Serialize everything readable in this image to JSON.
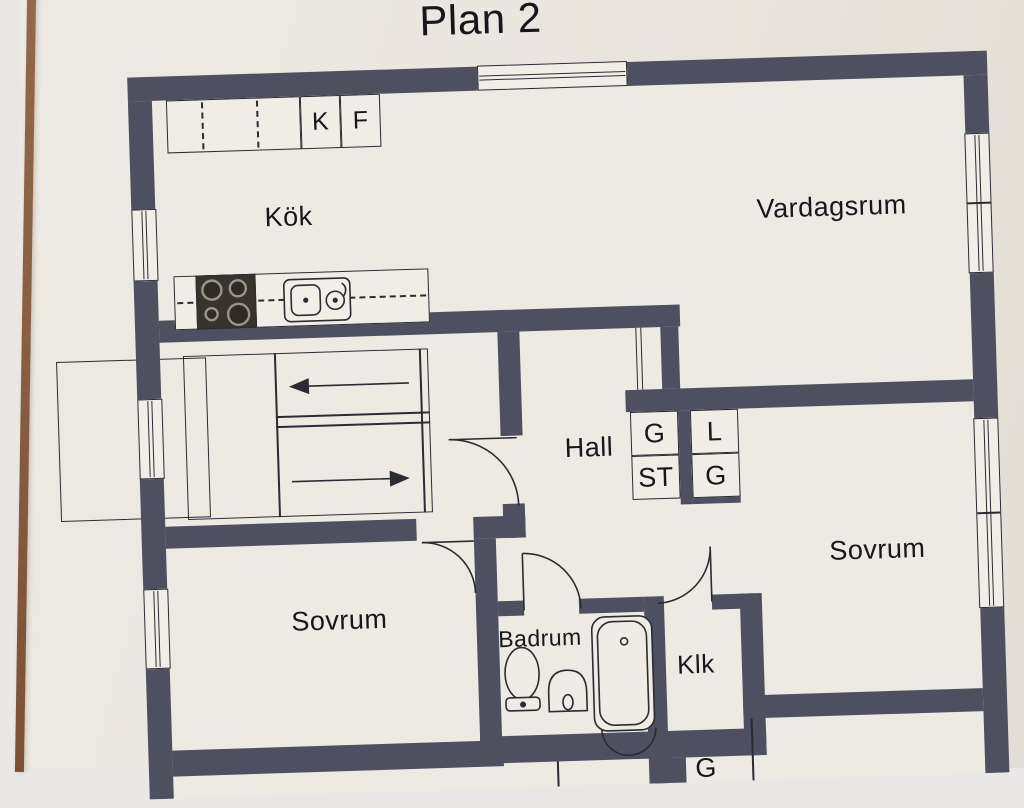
{
  "page": {
    "title": "Plan 2"
  },
  "floor_plan": {
    "rooms": {
      "kok": "Kök",
      "vardagsrum": "Vardagsrum",
      "hall": "Hall",
      "sovrum_left": "Sovrum",
      "sovrum_right": "Sovrum",
      "badrum": "Badrum",
      "klk": "Klk"
    },
    "kitchen_units": {
      "kyl": "K",
      "frys": "F"
    },
    "closets": {
      "garderob_1": "G",
      "stadskap": "ST",
      "linneskap": "L",
      "garderob_2": "G",
      "garderob_partial": "G"
    },
    "colors": {
      "wall": "#4e4f5f",
      "paper": "#e9e5de",
      "floor": "#edeae3",
      "line": "#2b2b33",
      "page_edge": "#82573c"
    }
  }
}
